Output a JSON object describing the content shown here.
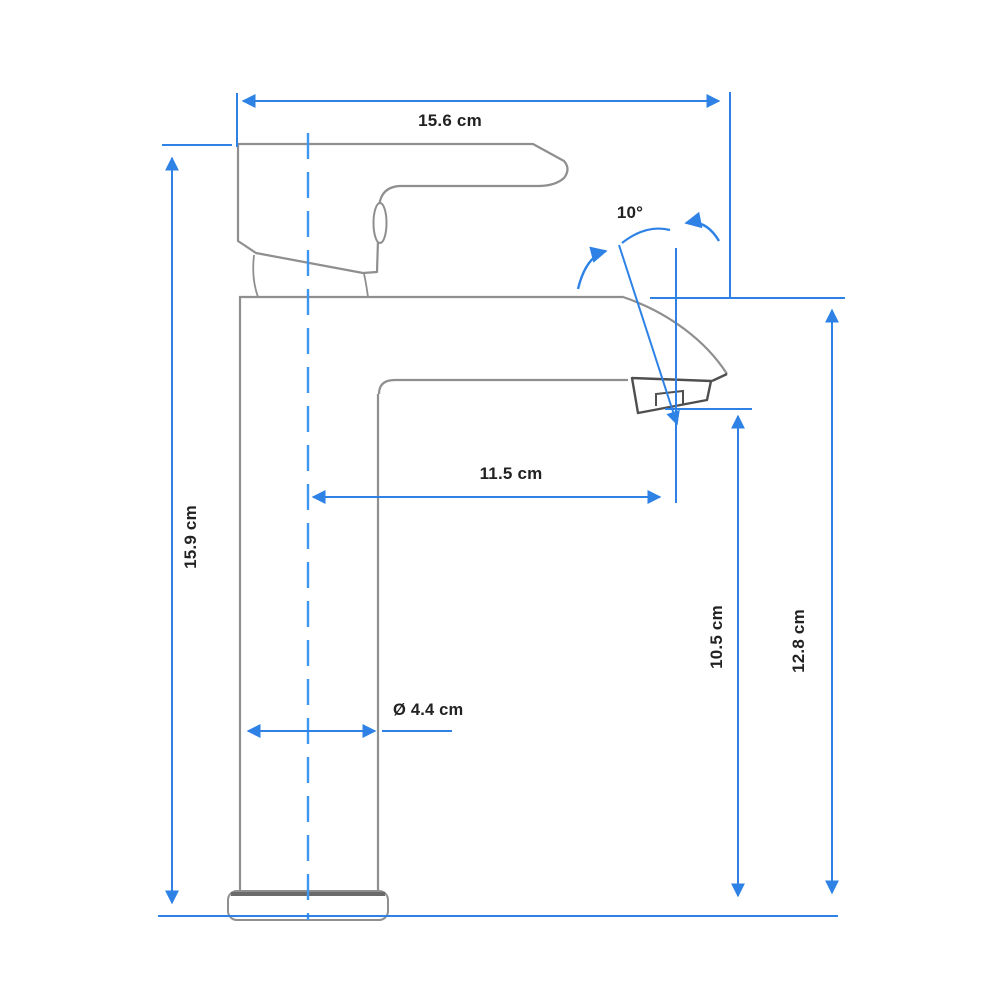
{
  "diagram": {
    "description": "Technical line drawing of a single-lever basin mixer tap, side view, with blue dimension lines",
    "labels": {
      "width_top": "15.6 cm",
      "height_left": "15.9 cm",
      "spout_reach": "11.5 cm",
      "base_diameter": "Ø 4.4 cm",
      "outlet_height": "10.5 cm",
      "spout_height": "12.8 cm",
      "handle_angle": "10°"
    },
    "colors": {
      "dimension_blue": "#2e82e6",
      "centerline_blue": "#3d96f2",
      "outline_gray": "#8f8f8f",
      "outline_dark": "#4f4f4f",
      "text": "#222222",
      "background": "#ffffff"
    }
  }
}
